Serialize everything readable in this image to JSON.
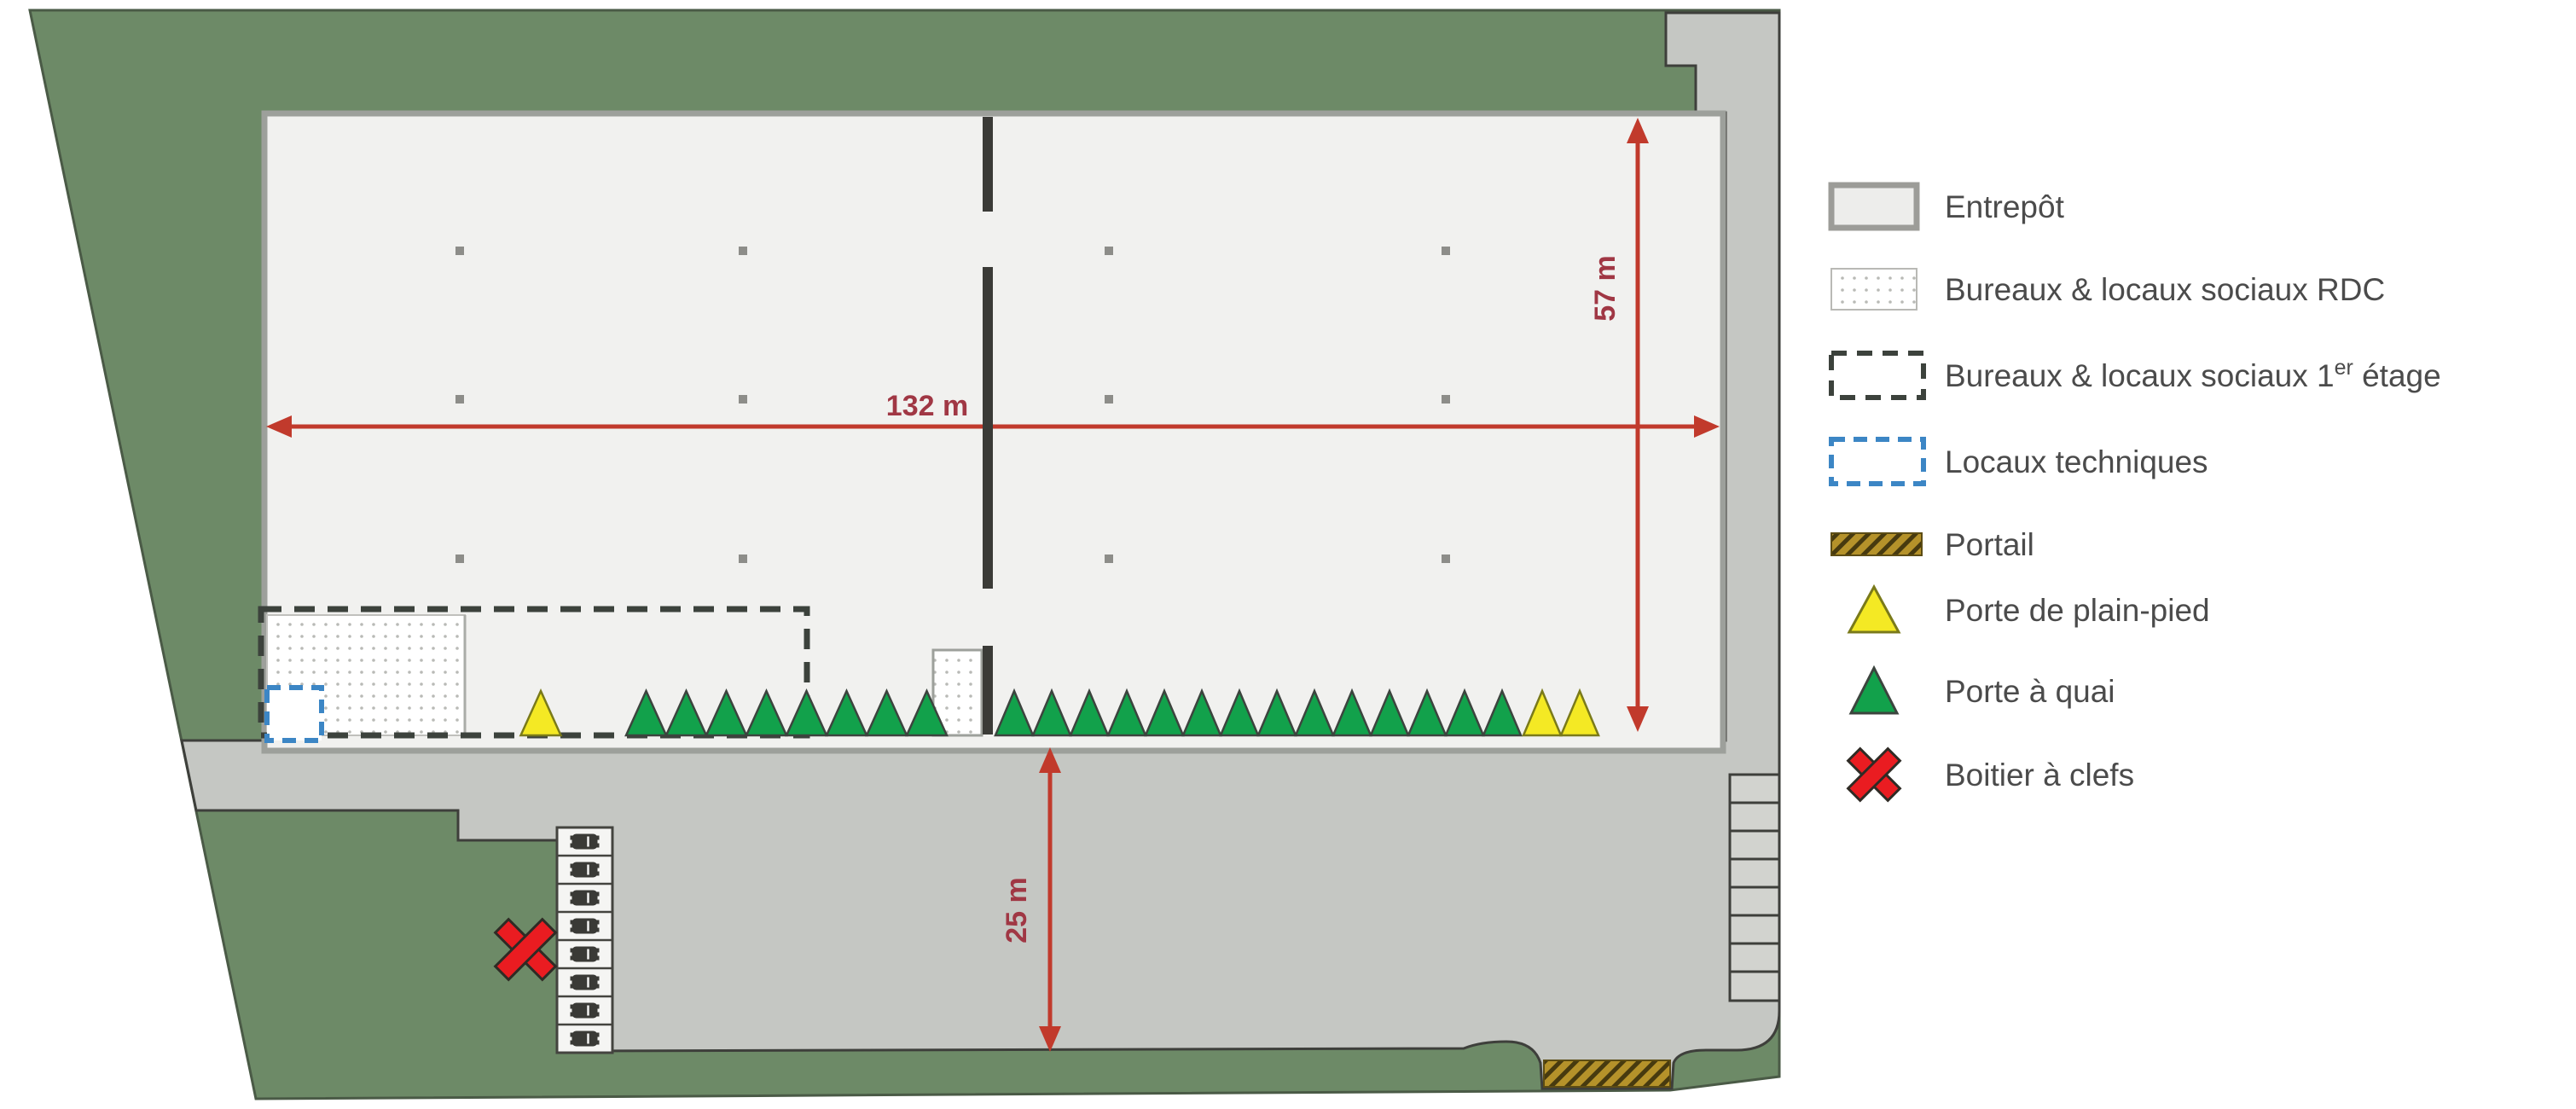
{
  "site_plan": {
    "dimensions": {
      "building_width_label": "132 m",
      "building_depth_label": "57 m",
      "yard_depth_label": "25 m"
    },
    "doors": {
      "left_yellow_count": 1,
      "left_green_count": 8,
      "right_green_count": 14,
      "right_yellow_count": 2
    },
    "parking_space_count": 8,
    "dock_stair_cell_count": 8
  },
  "legend": {
    "items": [
      {
        "id": "entrepot",
        "label": "Entrepôt",
        "swatch": "solid-grey"
      },
      {
        "id": "bureaux-rdc",
        "label": "Bureaux & locaux sociaux RDC",
        "swatch": "dotted-white"
      },
      {
        "id": "bureaux-1er-etage",
        "label": "Bureaux & locaux sociaux 1er étage",
        "label_base": "Bureaux & locaux sociaux 1",
        "label_sup": "er",
        "label_end": " étage",
        "swatch": "dashed-dark"
      },
      {
        "id": "locaux-techniques",
        "label": "Locaux techniques",
        "swatch": "dashed-blue"
      },
      {
        "id": "portail",
        "label": "Portail",
        "swatch": "hatched-gold"
      },
      {
        "id": "porte-plain-pied",
        "label": "Porte de plain-pied",
        "swatch": "triangle-yellow"
      },
      {
        "id": "porte-a-quai",
        "label": "Porte à quai",
        "swatch": "triangle-green"
      },
      {
        "id": "boitier-a-clefs",
        "label": "Boitier à clefs",
        "swatch": "cross-red"
      }
    ]
  },
  "colors": {
    "grass_green": "#6d8a67",
    "paved_grey": "#c5c7c3",
    "building_fill": "#f1f1ef",
    "building_border": "#9da09b",
    "wall_dark": "#3b3b37",
    "dashed_dark": "#3c423c",
    "dashed_blue": "#3c86c5",
    "door_yellow": "#f4e924",
    "door_green": "#12a14b",
    "dimension_red": "#c13a2c",
    "dimension_label_red": "#a03744",
    "gate_gold": "#b5922a",
    "key_box_red": "#ea1c21",
    "legend_text": "#4b4b4b"
  }
}
